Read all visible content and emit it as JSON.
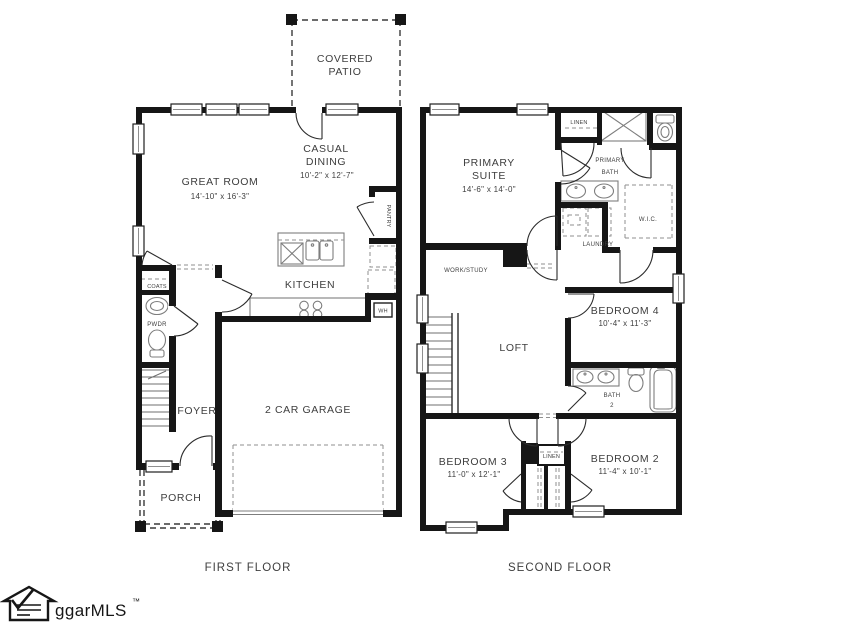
{
  "colors": {
    "walls": "#161616",
    "text": "#3e3e3e",
    "fixtures": "#7d7d7d",
    "background": "#ffffff"
  },
  "ff": {
    "caption": "FIRST FLOOR",
    "covered_patio_1": "COVERED",
    "covered_patio_2": "PATIO",
    "great_room": "GREAT ROOM",
    "great_room_dim": "14'-10\" x 16'-3\"",
    "casual_1": "CASUAL",
    "casual_2": "DINING",
    "casual_dim": "10'-2\" x 12'-7\"",
    "kitchen": "KITCHEN",
    "pantry": "PANTRY",
    "coats": "COATS",
    "pwdr": "PWDR",
    "foyer": "FOYER",
    "garage": "2 CAR GARAGE",
    "porch": "PORCH",
    "wh": "WH"
  },
  "sf": {
    "caption": "SECOND FLOOR",
    "primary_suite_1": "PRIMARY",
    "primary_suite_2": "SUITE",
    "primary_suite_dim": "14'-6\" x 14'-0\"",
    "linen_top": "LINEN",
    "primary_bath_1": "PRIMARY",
    "primary_bath_2": "BATH",
    "wic": "W.I.C.",
    "laundry": "LAUNDRY",
    "work_study": "WORK/STUDY",
    "loft": "LOFT",
    "bedroom4": "BEDROOM 4",
    "bedroom4_dim": "10'-4\" x 11'-3\"",
    "bath2_1": "BATH",
    "bath2_2": "2",
    "bedroom3": "BEDROOM 3",
    "bedroom3_dim": "11'-0\" x 12'-1\"",
    "linen_mid": "LINEN",
    "bedroom2": "BEDROOM 2",
    "bedroom2_dim": "11'-4\" x 10'-1\""
  },
  "logo": {
    "text": "ggarMLS",
    "tm": "™"
  }
}
